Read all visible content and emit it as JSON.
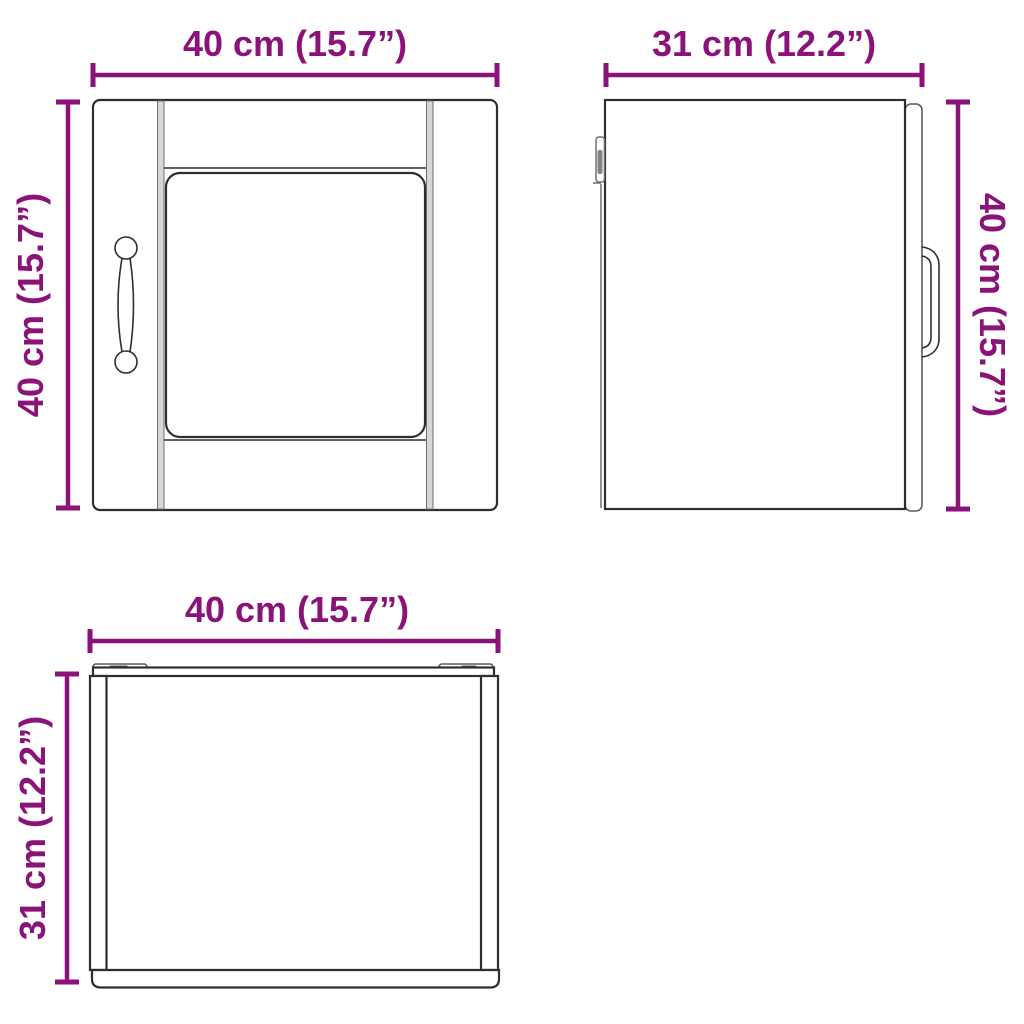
{
  "page": {
    "background": "#ffffff",
    "description_labels": {
      "front_view": "front-view",
      "side_view": "side-view",
      "bottom_view": "bottom-view"
    }
  },
  "colors": {
    "dimension": "#8B1278",
    "line": "#2e2e2e"
  },
  "views": {
    "front": {
      "width_label": "40 cm (15.7”)",
      "height_label": "40 cm (15.7”)"
    },
    "side": {
      "width_label": "31 cm (12.2”)",
      "height_label": "40 cm (15.7”)"
    },
    "bottom": {
      "width_label": "40 cm (15.7”)",
      "height_label": "31 cm (12.2”)"
    }
  }
}
